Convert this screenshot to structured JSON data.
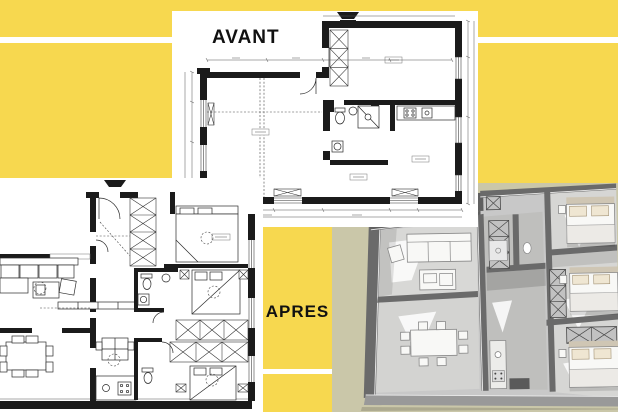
{
  "title": "AVANT / APRES apartment floor-plan comparison collage",
  "labels": {
    "avant": "AVANT",
    "apres": "APRES"
  },
  "colors": {
    "background_yellow": "#F7D84F",
    "stripe_white": "#FFFFFF",
    "panel_white": "#FFFFFF",
    "plan_ink": "#1B1B1B",
    "render_bg_tan": "#CAC7A9",
    "render_wall_grey": "#646464",
    "render_floor_grey": "#CBCBCB",
    "label_text": "#111111"
  },
  "panels": {
    "avant": {
      "label": "AVANT",
      "content": "2D architectural floor plan with walls, windows and dimension lines"
    },
    "apres": {
      "label": "APRES",
      "content": "2D furnished floor plan: living room, dining, kitchen, bathrooms, three bedrooms, X-front wardrobes"
    },
    "render": {
      "content": "greyscale 3D axonometric render of the furnished apartment on tan background"
    }
  }
}
